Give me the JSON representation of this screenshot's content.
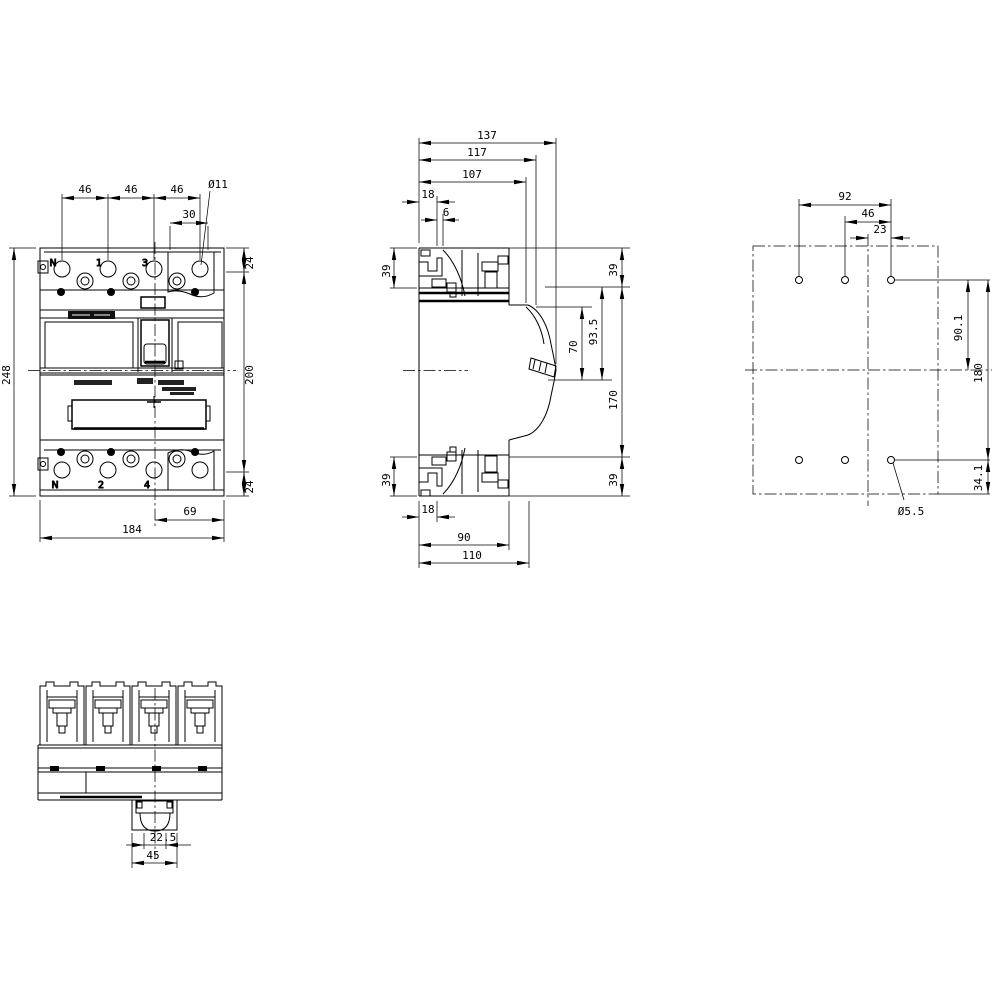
{
  "drawing": {
    "kind": "dimension-drawing-4pole-molded-case-circuit-breaker",
    "front_view": {
      "terminals_top": [
        "N",
        "1",
        "3"
      ],
      "terminals_bottom": [
        "N",
        "2",
        "4"
      ],
      "dims": {
        "pole_pitch": [
          "46",
          "46",
          "46"
        ],
        "hole_offset": "30",
        "hole_diameter": "Ø11",
        "height_top": "24",
        "height_mid": "200",
        "height_bottom": "24",
        "height_overall": "248",
        "hole_edge_offset": "69",
        "width_overall": "184"
      }
    },
    "side_view": {
      "dims": {
        "depth_overall": "137",
        "depth_handle": "117",
        "depth_escutcheon": "107",
        "top_rear_offset": "18",
        "top_rear_step": "6",
        "rear_top": "39",
        "rear_bottom": "39",
        "front_top": "39",
        "front_bottom": "39",
        "handle_window": "70",
        "handle_travel": "93.5",
        "body_height": "170",
        "bottom_rear_offset": "18",
        "mounting_depth": "90",
        "base_depth": "110"
      }
    },
    "drill_view": {
      "dims": {
        "span_outer": "92",
        "span_inner": "46",
        "span_center": "23",
        "row_to_center": "90.1",
        "row_spacing": "180",
        "row_to_edge": "34.1",
        "hole_diameter": "Ø5.5"
      }
    },
    "bottom_view": {
      "dims": {
        "handle_width": "22.5",
        "handle_base_width": "45"
      }
    }
  }
}
